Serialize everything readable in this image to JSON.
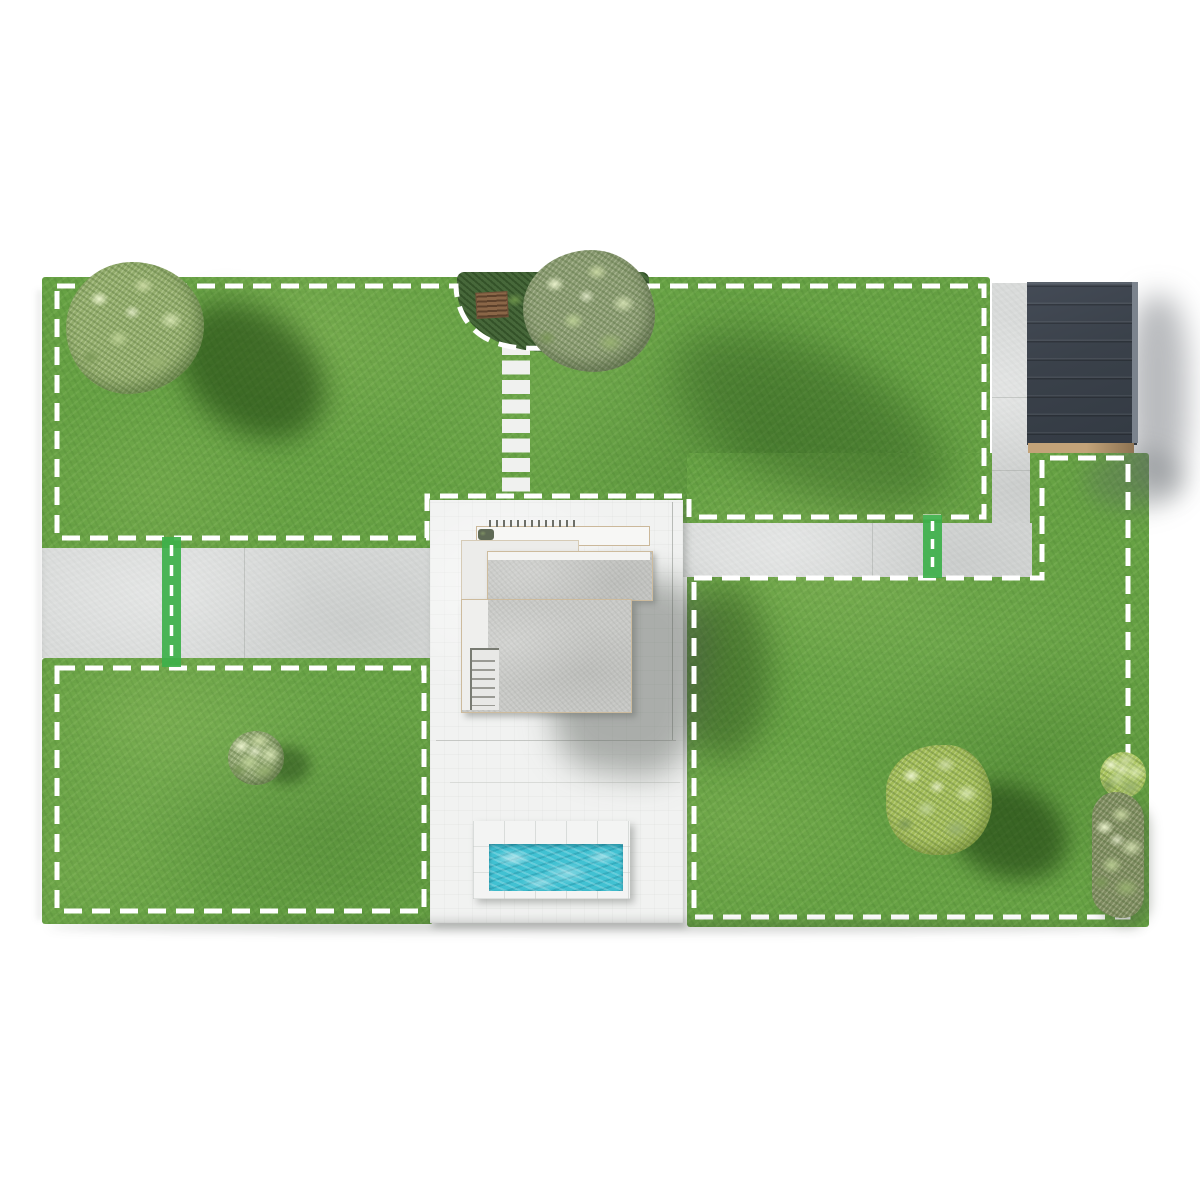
{
  "scene": {
    "description": "Top-down 3D rendered map of a residential garden with white dashed mowing-zone boundaries and green passage markers",
    "background": "#ffffff"
  },
  "palette": {
    "grass": "#67a244",
    "path": "#d9dbda",
    "pad": "#f1f2f1",
    "roof": "#c8c9c6",
    "structure": "#3a414a",
    "structure_trim": "#c3a379",
    "pool_water": "#41c1d2",
    "pool_deck": "#f3f4f3",
    "boundary": "#ffffff",
    "passage": "#3db04a",
    "bed": "#47683a",
    "sage": "#93ad6c",
    "bright": "#a3bd58",
    "olivebush": "#7e8a60"
  },
  "overlays": {
    "boundary_style": {
      "color": "#ffffff",
      "dash": "18 10",
      "width": 5
    },
    "zone_count": 3,
    "passage_count": 2
  },
  "zones": {
    "top_lawn": {
      "id": "zone-top-lawn"
    },
    "bottom_left_lawn": {
      "id": "zone-bottom-left-lawn"
    },
    "right_lawn": {
      "id": "zone-right-lawn"
    }
  },
  "objects": {
    "house": {
      "id": "house"
    },
    "pool": {
      "id": "pool"
    },
    "carport_roof": {
      "id": "carport-solar-roof"
    },
    "garden_bed": {
      "id": "garden-bed"
    },
    "stepping_stones": {
      "count": 8
    },
    "trees": [
      "top-left-tree",
      "olive-tree",
      "round-shrub",
      "bright-tree",
      "edge-shrubs"
    ]
  }
}
